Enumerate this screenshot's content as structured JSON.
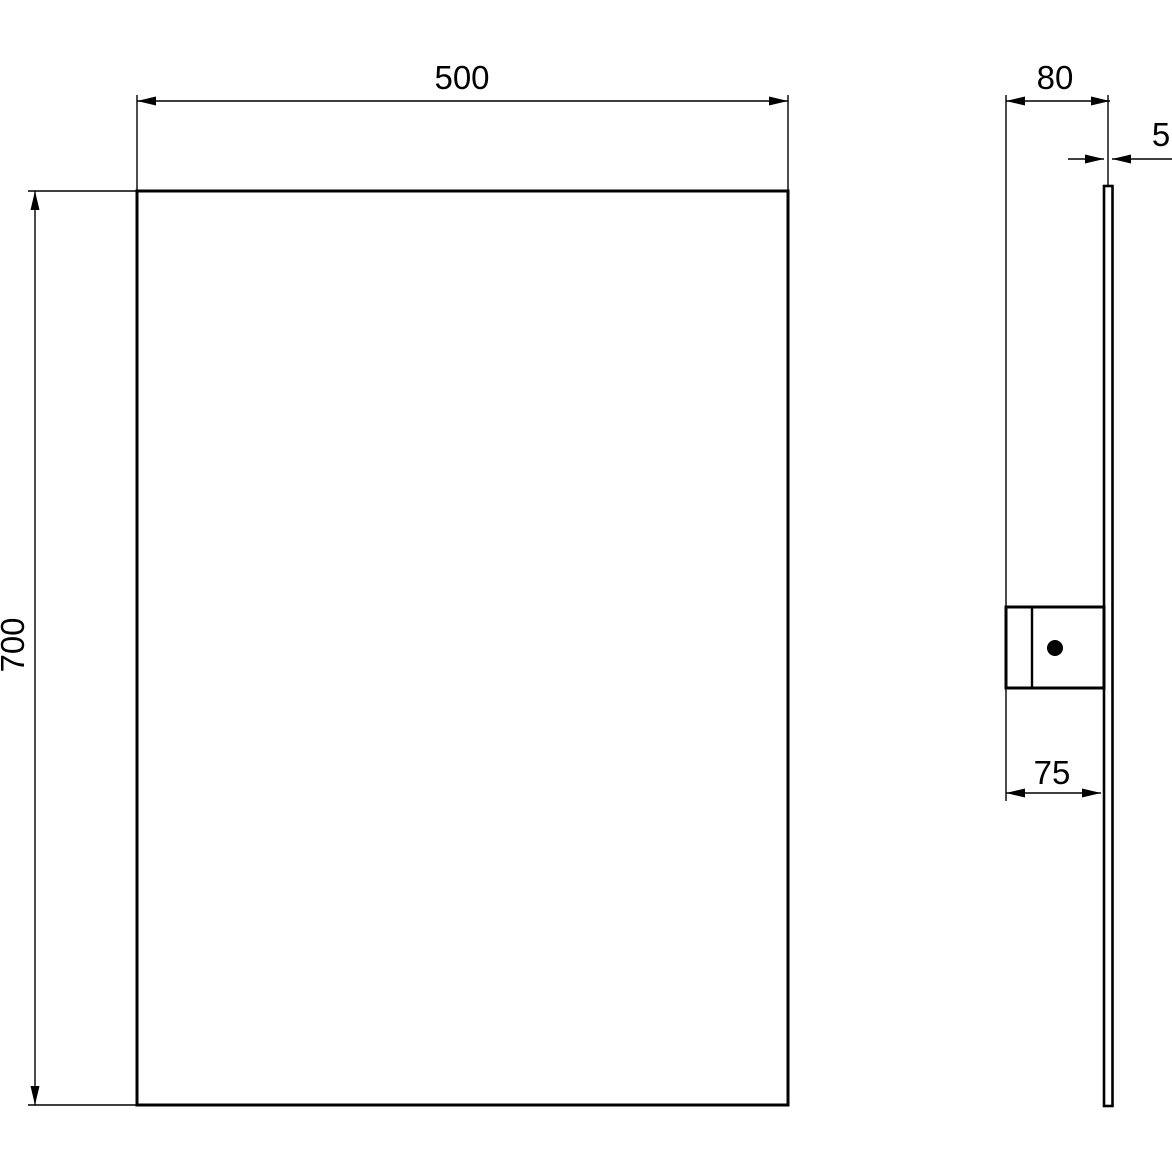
{
  "dimensions": {
    "front_width": "500",
    "front_height": "700",
    "side_depth": "80",
    "glass_thickness": "5",
    "bracket_depth": "75"
  },
  "colors": {
    "line": "#000000",
    "background": "#ffffff"
  }
}
